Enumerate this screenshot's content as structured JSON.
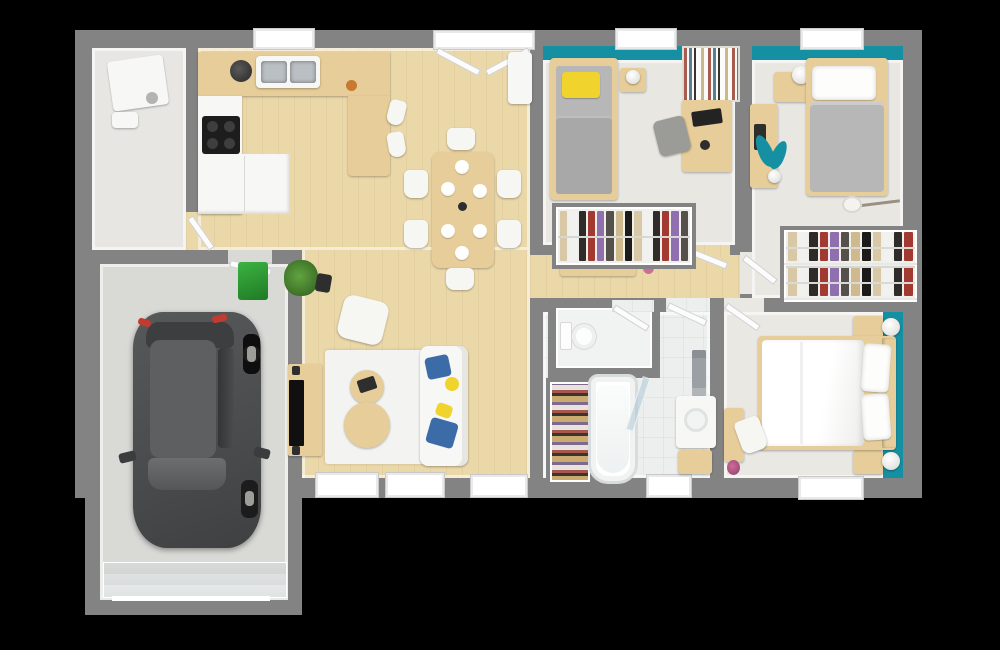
{
  "meta": {
    "type": "3d-floor-plan-top-view",
    "description": "Photorealistic top-down 3D render of a single-storey house floor plan with attached garage on black background",
    "canvas": {
      "width_px": 1000,
      "height_px": 650
    }
  },
  "colors": {
    "background": "#000000",
    "wall": "#838383",
    "wood_floor": "#ebd8a9",
    "wood_furniture": "#e6cd99",
    "bedroom_floor": "#e9e7e2",
    "master_floor": "#eae8e3",
    "tile_floor": "#edefef",
    "laundry_floor": "#e7e6e3",
    "garage_floor": "#d9d9d6",
    "teal_accent": "#1590a2",
    "white_surface": "#f7f7f5",
    "rug": "#f3f3f1",
    "mattress_gray": "#b7b7b7",
    "blanket_gray": "#a8a8a8",
    "pillow_yellow": "#f0d32c",
    "cushion_blue": "#3c6ca8",
    "plant_green": "#45822f",
    "bin_green": "#2f9e34",
    "car_body": "#4a4c4d",
    "car_roof": "#5d5f60",
    "car_glass": "#3c3e3f",
    "tail_light_red": "#c23b30",
    "steel": "#b9bfc3",
    "dark_item": "#2e2e2e",
    "flower_pink": "#d06a9a",
    "clothes": [
      "#d8c8a6",
      "#f1f1ef",
      "#2e2b28",
      "#a23a32",
      "#8f6fae",
      "#55504a",
      "#cfb98e",
      "#1d1b19"
    ]
  },
  "rooms": [
    {
      "id": "garage",
      "name": "Garage",
      "furniture": [
        "car",
        "green-bin",
        "sectional-garage-door",
        "service-door-to-house"
      ]
    },
    {
      "id": "laundry",
      "name": "Laundry / utility room",
      "furniture": [
        "washing-machine",
        "storage-box"
      ]
    },
    {
      "id": "kitchen",
      "name": "Kitchen",
      "furniture": [
        "u-shaped-counter",
        "double-steel-sink",
        "coffee-machine",
        "4-burner-cooktop",
        "white-base-cabinets",
        "peninsula",
        "bar-stools"
      ],
      "counts": {
        "bar_stools": 2
      }
    },
    {
      "id": "dining",
      "name": "Dining area",
      "furniture": [
        "dining-table",
        "chairs",
        "plates",
        "center-vase",
        "entry-double-door",
        "entry-console"
      ],
      "counts": {
        "chairs": 6,
        "plates": 6
      }
    },
    {
      "id": "living",
      "name": "Living room",
      "furniture": [
        "area-rug",
        "sofa",
        "blue-cushions",
        "yellow-cushions",
        "armchair",
        "coffee-table-small",
        "coffee-table-large",
        "tv-sideboard",
        "wall-tv",
        "potted-plant",
        "stool"
      ],
      "counts": {
        "windows": 3
      }
    },
    {
      "id": "hall",
      "name": "Hallway",
      "furniture": [
        "console-shelf",
        "flower-pot"
      ]
    },
    {
      "id": "bedroom1",
      "name": "Bedroom 1",
      "furniture": [
        "single-bed",
        "yellow-pillow",
        "nightstand",
        "lamp",
        "bookshelf",
        "desk",
        "monitor",
        "desk-chair",
        "open-wardrobe"
      ],
      "accent": "teal top wall"
    },
    {
      "id": "bedroom2",
      "name": "Bedroom 2",
      "furniture": [
        "single-bed",
        "nightstand",
        "lamp",
        "desk",
        "teal-leaf-decal",
        "guitar",
        "double-rail-closet"
      ],
      "accent": "teal top wall"
    },
    {
      "id": "master_bedroom",
      "name": "Master bedroom",
      "furniture": [
        "double-bed",
        "pillows",
        "nightstands",
        "ball-lamps",
        "desk",
        "chair",
        "flower-pot"
      ],
      "counts": {
        "pillows": 2,
        "nightstands": 2
      },
      "accent": "teal right wall"
    },
    {
      "id": "bathroom",
      "name": "Bathroom",
      "furniture": [
        "bathtub",
        "glass-screen",
        "shoe-shelf",
        "vanity-sink",
        "wooden-crate",
        "towel-rack"
      ]
    },
    {
      "id": "wc",
      "name": "WC",
      "furniture": [
        "toilet"
      ]
    }
  ]
}
